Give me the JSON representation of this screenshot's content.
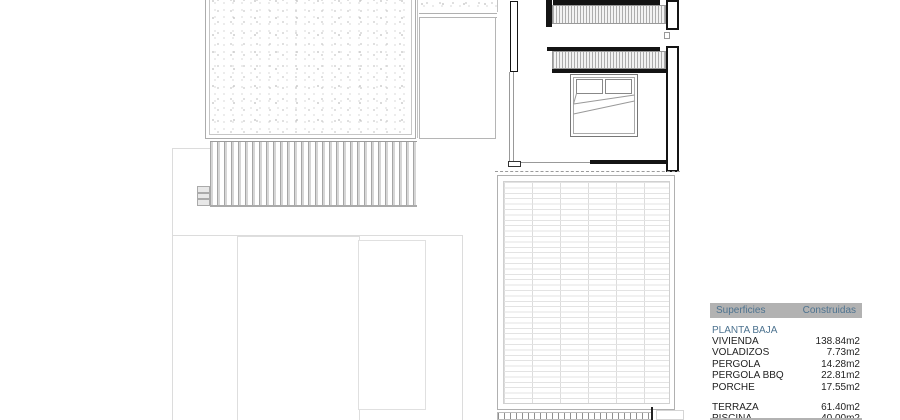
{
  "legend": {
    "columns": [
      "Superficies",
      "Construidas"
    ],
    "sections": [
      {
        "title": "PLANTA BAJA",
        "rows": [
          {
            "label": "VIVIENDA",
            "value": "138.84m2"
          },
          {
            "label": "VOLADIZOS",
            "value": "7.73m2"
          },
          {
            "label": "PERGOLA",
            "value": "14.28m2"
          },
          {
            "label": "PERGOLA BBQ",
            "value": "22.81m2"
          },
          {
            "label": "PORCHE",
            "value": "17.55m2"
          }
        ]
      },
      {
        "title": "",
        "rows": [
          {
            "label": "TERRAZA",
            "value": "61.40m2"
          },
          {
            "label": "PISCINA",
            "value": "40.00m2"
          }
        ]
      }
    ]
  },
  "colors": {
    "legend_header_bg": "#b2b2b2",
    "legend_accent_text": "#4d7390",
    "legend_row_text": "#1f1f1f",
    "wall_black": "#141414",
    "drawing_line": "#9a9a9a",
    "drawing_line_light": "#dcdcdc"
  }
}
